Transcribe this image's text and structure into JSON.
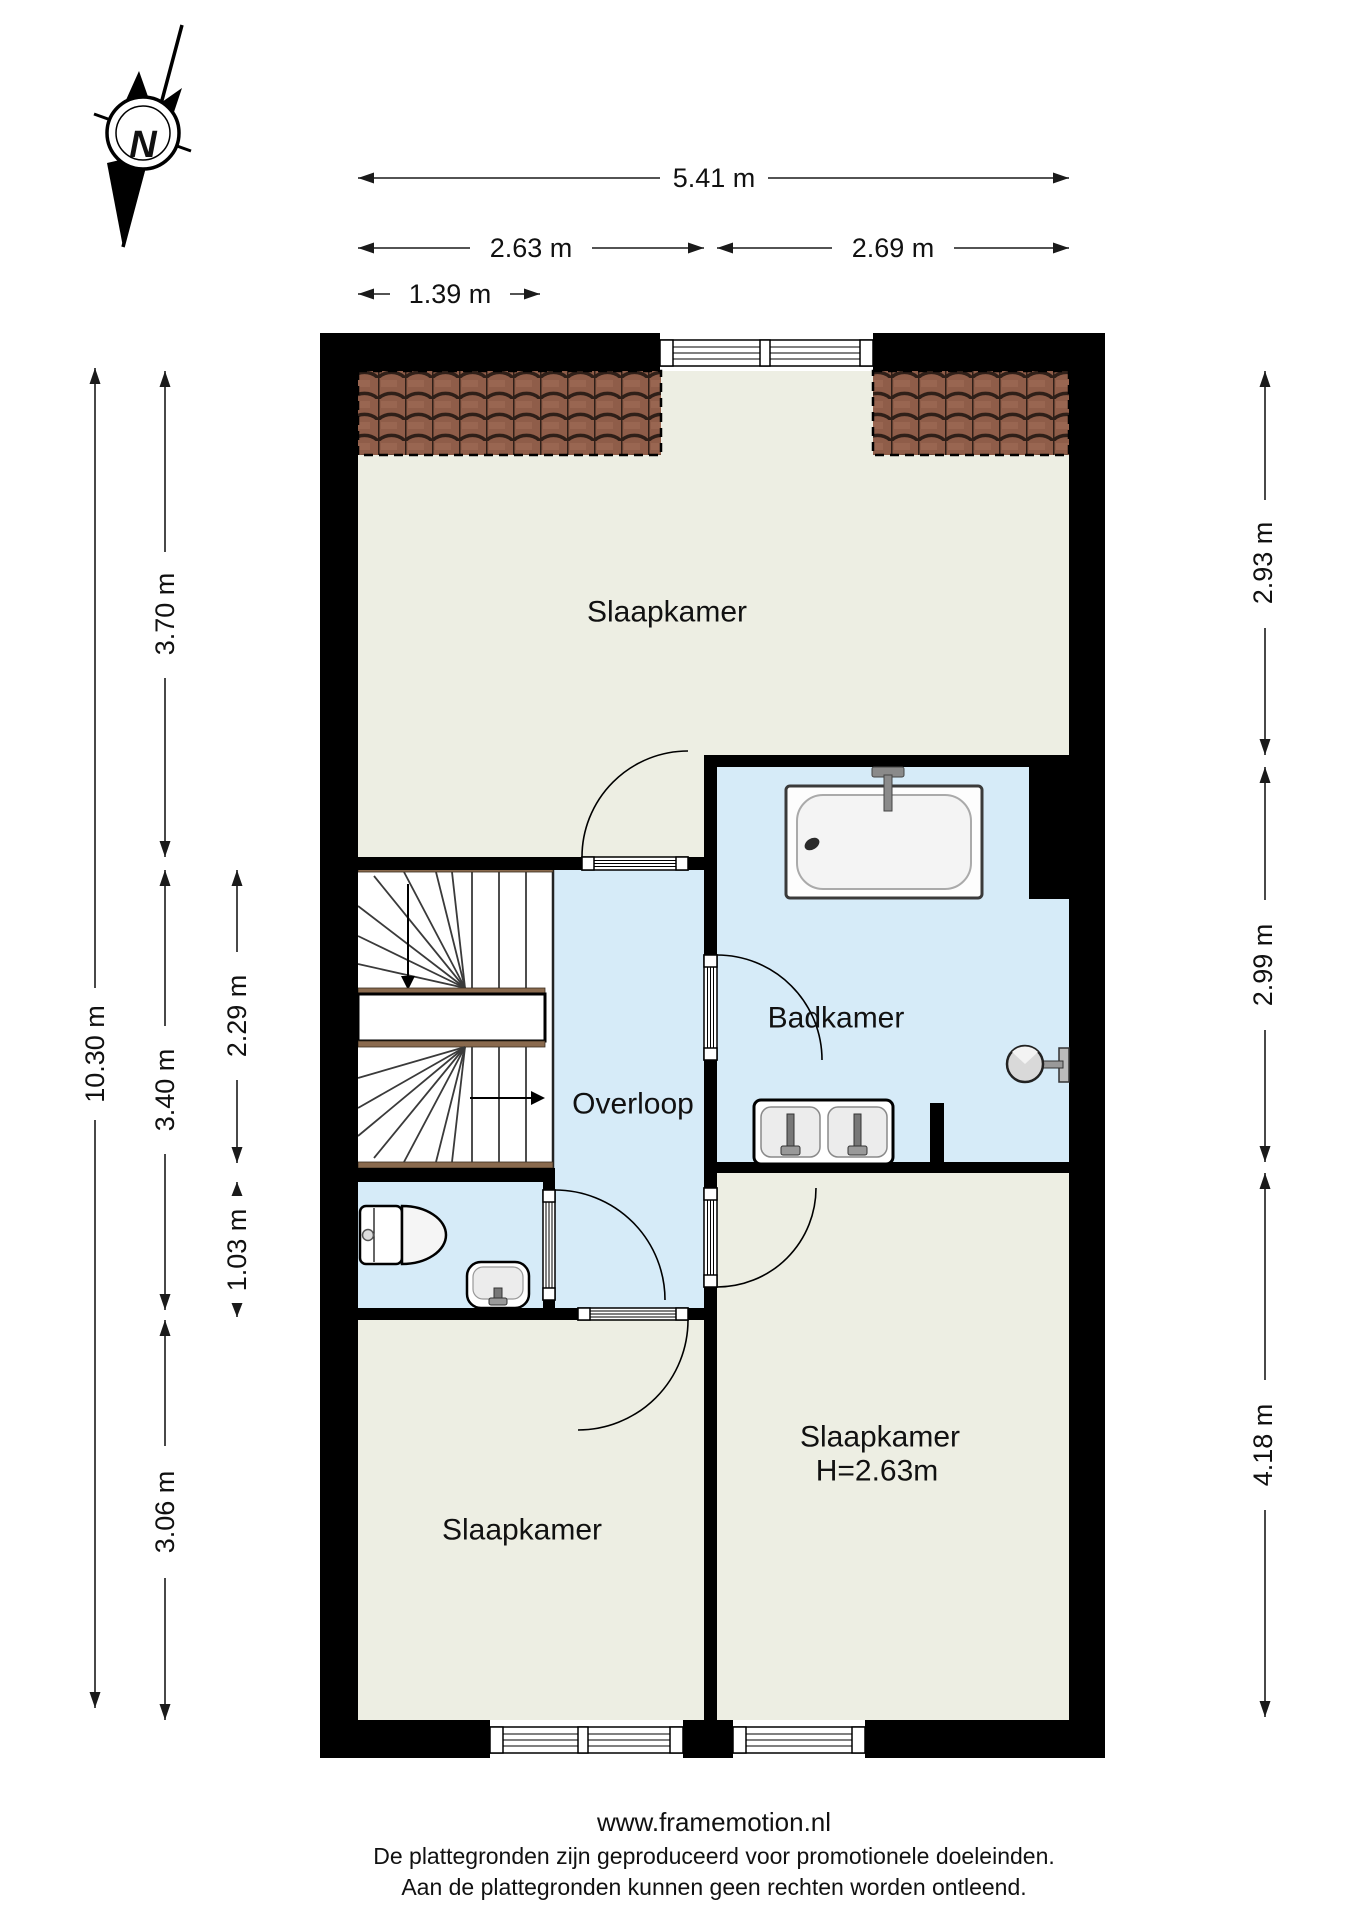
{
  "compass": {
    "north_label": "N"
  },
  "rooms": {
    "slaapkamer_top": {
      "label": "Slaapkamer"
    },
    "badkamer": {
      "label": "Badkamer"
    },
    "overloop": {
      "label": "Overloop"
    },
    "slaapkamer_left": {
      "label": "Slaapkamer"
    },
    "slaapkamer_right": {
      "label": "Slaapkamer",
      "height_note": "H=2.63m"
    }
  },
  "dimensions": {
    "top": [
      {
        "label": "5.41 m"
      },
      {
        "label": "2.63 m"
      },
      {
        "label": "2.69 m"
      },
      {
        "label": "1.39 m"
      }
    ],
    "left": [
      {
        "label": "10.30 m"
      },
      {
        "label": "3.70 m"
      },
      {
        "label": "3.40 m"
      },
      {
        "label": "2.29 m"
      },
      {
        "label": "1.03 m"
      },
      {
        "label": "3.06 m"
      }
    ],
    "right": [
      {
        "label": "2.93 m"
      },
      {
        "label": "2.99 m"
      },
      {
        "label": "4.18 m"
      }
    ]
  },
  "footer": {
    "website": "www.framemotion.nl",
    "disclaimer_line1": "De plattegronden zijn geproduceerd voor promotionele doeleinden.",
    "disclaimer_line2": "Aan de plattegronden kunnen geen rechten worden ontleend."
  },
  "colors": {
    "wall": "#000000",
    "dry_room_floor": "#edeee3",
    "wet_room_floor": "#d6ebf8",
    "roof_tile": "#8f5d49",
    "stair_wood": "#8a6a4e"
  }
}
